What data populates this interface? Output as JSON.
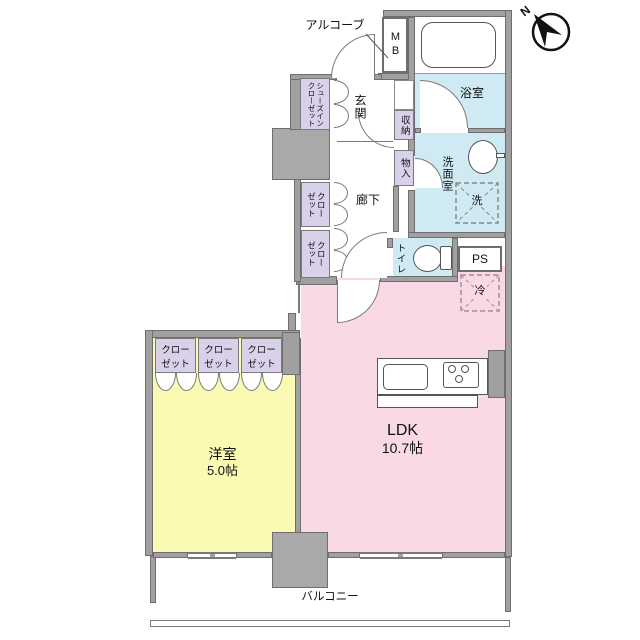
{
  "floorplan": {
    "compass": "N",
    "rooms": {
      "ldk": {
        "name": "LDK",
        "size": "10.7帖"
      },
      "western": {
        "name": "洋室",
        "size": "5.0帖"
      },
      "bath": "浴室",
      "washroom": "洗面室",
      "toilet": "トイレ",
      "entrance": "玄関",
      "corridor": "廊下",
      "balcony": "バルコニー",
      "alcove": "アルコーブ"
    },
    "storage": {
      "shoe_closet": [
        "シューズイン",
        "クローゼット"
      ],
      "closet": [
        "クロー",
        "ゼット"
      ],
      "storage_upper": "収納",
      "storage_lower": "物入"
    },
    "utility": {
      "meter_box": "MB",
      "pipe_space": "PS",
      "laundry": "洗",
      "refrigerator": "冷"
    },
    "colors": {
      "ldk_pink": "#f9d9e6",
      "western_yellow": "#fafab2",
      "wet_area_blue": "#cfeaf2",
      "closet_purple": "#d9d0ea",
      "wall_gray": "#a0a0a0"
    }
  }
}
